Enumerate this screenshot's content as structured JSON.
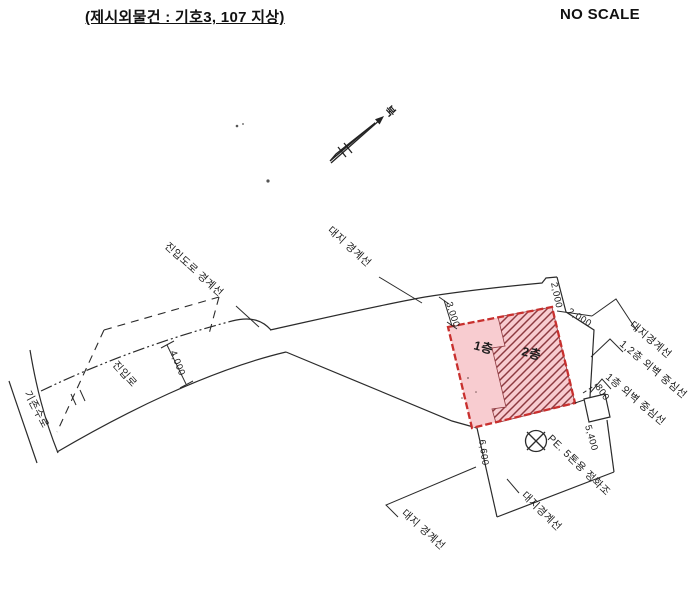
{
  "header": {
    "title": "(제시외물건 : 기호3, 107 지상)",
    "scale_label": "NO SCALE"
  },
  "compass": {
    "north_label": "북"
  },
  "site": {
    "boundary_label_top": "대지 경계선",
    "boundary_label_bottom_left": "대지 경계선",
    "boundary_label_bottom_right": "대지경계선",
    "boundary_label_right": "대지경계선",
    "access_road_boundary_label": "진입도로 경계선",
    "access_road_label": "진입로",
    "existing_waterway_label": "기존수로",
    "septic_label": "PE. 5톤용 정화조"
  },
  "building": {
    "floor1_label": "1층",
    "floor2_label": "2층",
    "wall_center_label_12": "1,2층 외벽 중심선",
    "wall_center_label_1": "1층 외벽 중심선"
  },
  "dimensions": {
    "setback_top_left": "3,000",
    "top_right_a": "2,000",
    "top_right_b": "2,000",
    "right_small": "800",
    "right_lower": "5,400",
    "bottom_left": "6,600",
    "road_width": "4,000"
  },
  "colors": {
    "building_fill": "#f8ccd0",
    "building_outline": "#c8302e",
    "hatch_line": "#8e3a40",
    "ink": "#2b2b2b"
  }
}
